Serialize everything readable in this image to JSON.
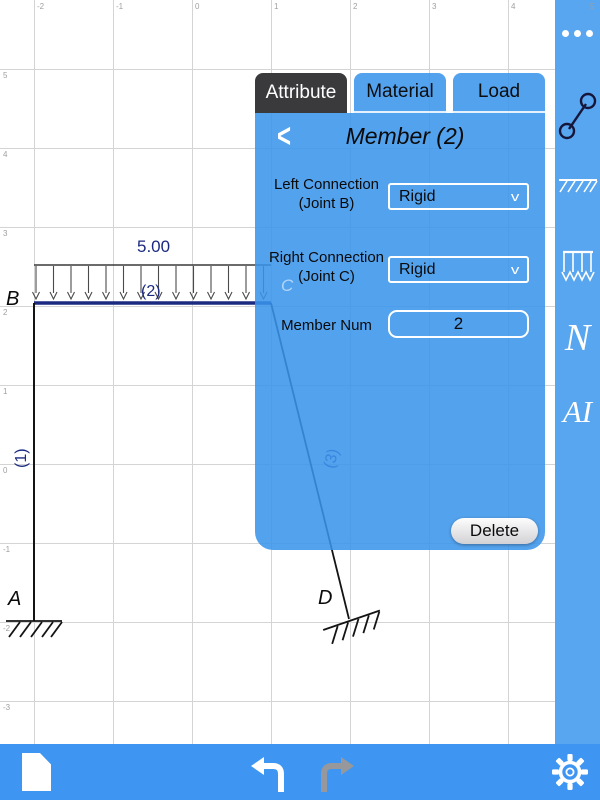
{
  "app": {
    "colors": {
      "panel_blue": "#58a5f0",
      "toolbar_blue": "#3e96f2",
      "active_tab": "#3a3a3c",
      "member_navy": "#1b2a80",
      "grid_gray": "#d4d4d4"
    }
  },
  "canvas": {
    "grid_col_labels": [
      "-2",
      "-1",
      "0",
      "1",
      "2",
      "3",
      "4",
      "5"
    ],
    "grid_row_labels": [
      "5",
      "4",
      "3",
      "2",
      "1",
      "0",
      "-1",
      "-2",
      "-3"
    ],
    "load_value": "5.00",
    "member_labels": {
      "m1": "(1)",
      "m2": "(2)",
      "m3": "(3)"
    },
    "joint_labels": {
      "A": "A",
      "B": "B",
      "C": "C",
      "D": "D"
    }
  },
  "panel": {
    "tabs": [
      {
        "label": "Attribute",
        "active": true
      },
      {
        "label": "Material",
        "active": false
      },
      {
        "label": "Load",
        "active": false
      }
    ],
    "back_chevron": "<",
    "title": "Member (2)",
    "fields": [
      {
        "label_line1": "Left Connection",
        "label_line2": "(Joint B)",
        "value": "Rigid",
        "chevron": "v"
      },
      {
        "label_line1": "Right Connection",
        "label_line2": "(Joint C)",
        "value": "Rigid",
        "chevron": "v"
      },
      {
        "label": "Member Num",
        "value": "2"
      }
    ],
    "delete_label": "Delete"
  },
  "sidebar": {
    "icons": [
      "more-ellipsis",
      "member-tool",
      "fixed-support-tool",
      "distributed-load-tool"
    ],
    "letter_n": "N",
    "letter_ai": "AI"
  },
  "toolbar": {
    "icons": [
      "new-document",
      "undo",
      "redo",
      "settings-gear"
    ]
  }
}
